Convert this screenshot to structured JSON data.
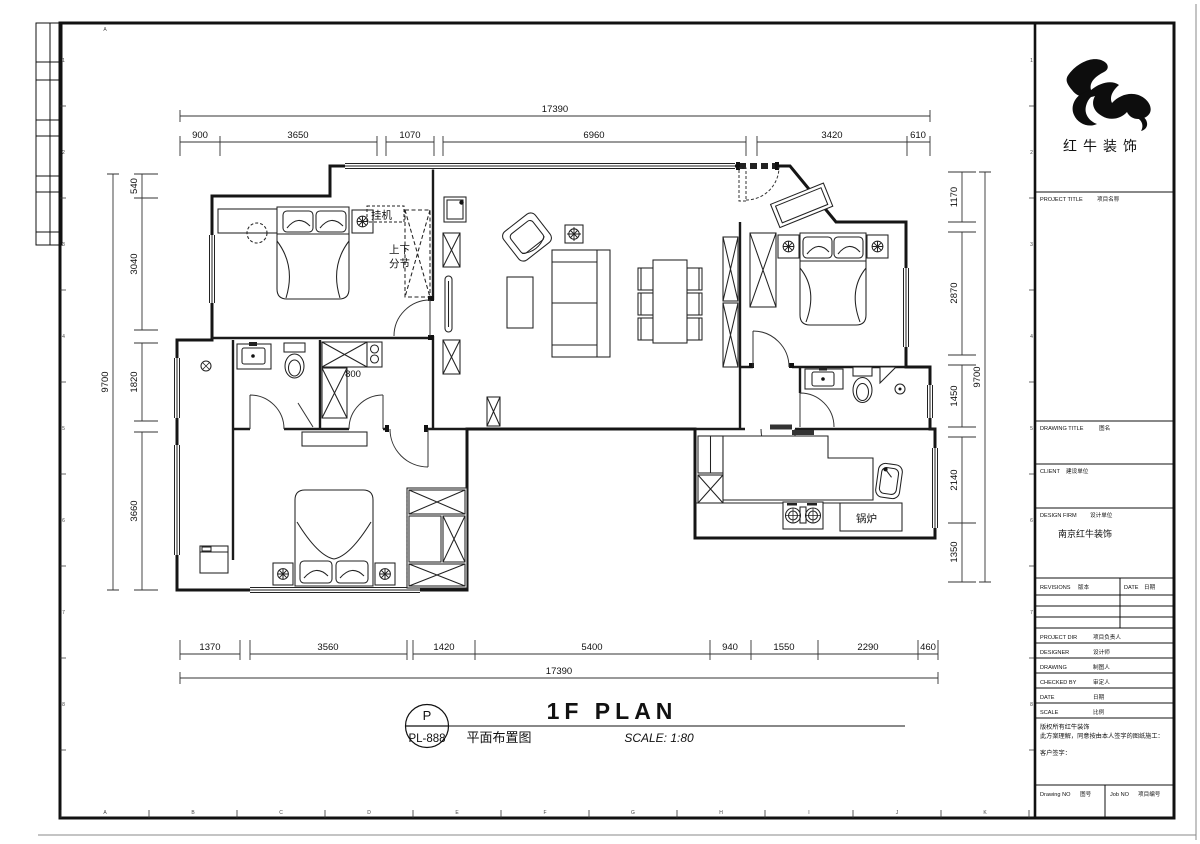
{
  "frame": {
    "grid_letter_top": "A",
    "grid_letters_bottom": [
      "A",
      "B",
      "C",
      "D",
      "E",
      "F",
      "G",
      "H",
      "I",
      "J",
      "K"
    ],
    "grid_numbers_side": [
      "1",
      "2",
      "3",
      "4",
      "5",
      "6",
      "7",
      "8"
    ]
  },
  "title_block": {
    "company_name": "红牛装饰",
    "project_title_en": "PROJECT TITLE",
    "project_title_cn": "项目名称",
    "drawing_title_en": "DRAWING TITLE",
    "drawing_title_cn": "图名",
    "client_en": "CLIENT",
    "client_cn": "建设单位",
    "design_firm_en": "DESIGN FIRM",
    "design_firm_cn": "设计单位",
    "design_firm_value": "南京红牛装饰",
    "revisions_en": "REVISIONS",
    "revisions_cn": "版本",
    "date_col_en": "DATE",
    "date_col_cn": "日期",
    "project_dir_en": "PROJECT DIR",
    "project_dir_cn": "项目负责人",
    "designer_en": "DESIGNER",
    "designer_cn": "设计师",
    "drawing_en": "DRAWING",
    "drawing_cn": "制图人",
    "checked_by_en": "CHECKED BY",
    "checked_by_cn": "审定人",
    "date_en": "DATE",
    "date_cn": "日期",
    "scale_en": "SCALE",
    "scale_cn": "比例",
    "note_line1": "版权所有红牛装饰",
    "note_line2": "此方案理解，同意按由本人签字的图纸施工：",
    "note_line3": "客户签字：",
    "drawing_no_en": "Drawing NO",
    "drawing_no_cn": "图号",
    "job_no_en": "Job NO",
    "job_no_cn": "项目编号"
  },
  "plan": {
    "labels": {
      "ac_unit": "挂机",
      "split_note_line1": "上下",
      "split_note_line2": "分节",
      "boiler": "锅炉",
      "cabinet_width": "800"
    },
    "dimensions": {
      "top_total": "17390",
      "top_segments": [
        "900",
        "3650",
        "1070",
        "6960",
        "3420",
        "610"
      ],
      "left_total": "9700",
      "left_segments": [
        "540",
        "3040",
        "1820",
        "3660"
      ],
      "right_total": "9700",
      "right_segments": [
        "1170",
        "2870",
        "1450",
        "2140",
        "1350"
      ],
      "bottom_total": "17390",
      "bottom_segments": [
        "1370",
        "3560",
        "1420",
        "5400",
        "940",
        "1550",
        "2290",
        "460"
      ]
    }
  },
  "footer": {
    "sheet_letter": "P",
    "sheet_number": "PL-888",
    "title_en": "1F PLAN",
    "title_cn": "平面布置图",
    "scale_label": "SCALE: 1:80"
  }
}
